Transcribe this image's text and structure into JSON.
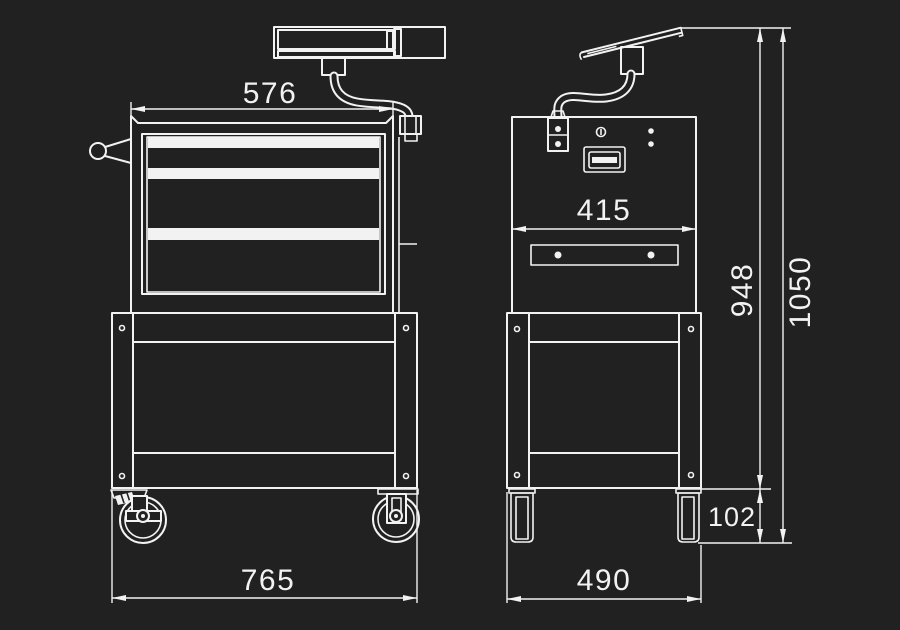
{
  "page": {
    "colors": {
      "background": "#212121",
      "line": "#f2f2f2"
    }
  },
  "drawing": {
    "type": "technical-drawing",
    "subject": "mobile workshop trolley with drawers, casters and monitor arm",
    "views": {
      "front": {
        "dims": {
          "top_width": "576",
          "overall_width": "765"
        }
      },
      "side": {
        "dims": {
          "panel_width": "415",
          "base_width": "490",
          "frame_height": "948",
          "overall_height": "1050",
          "caster_height": "102"
        }
      }
    }
  }
}
